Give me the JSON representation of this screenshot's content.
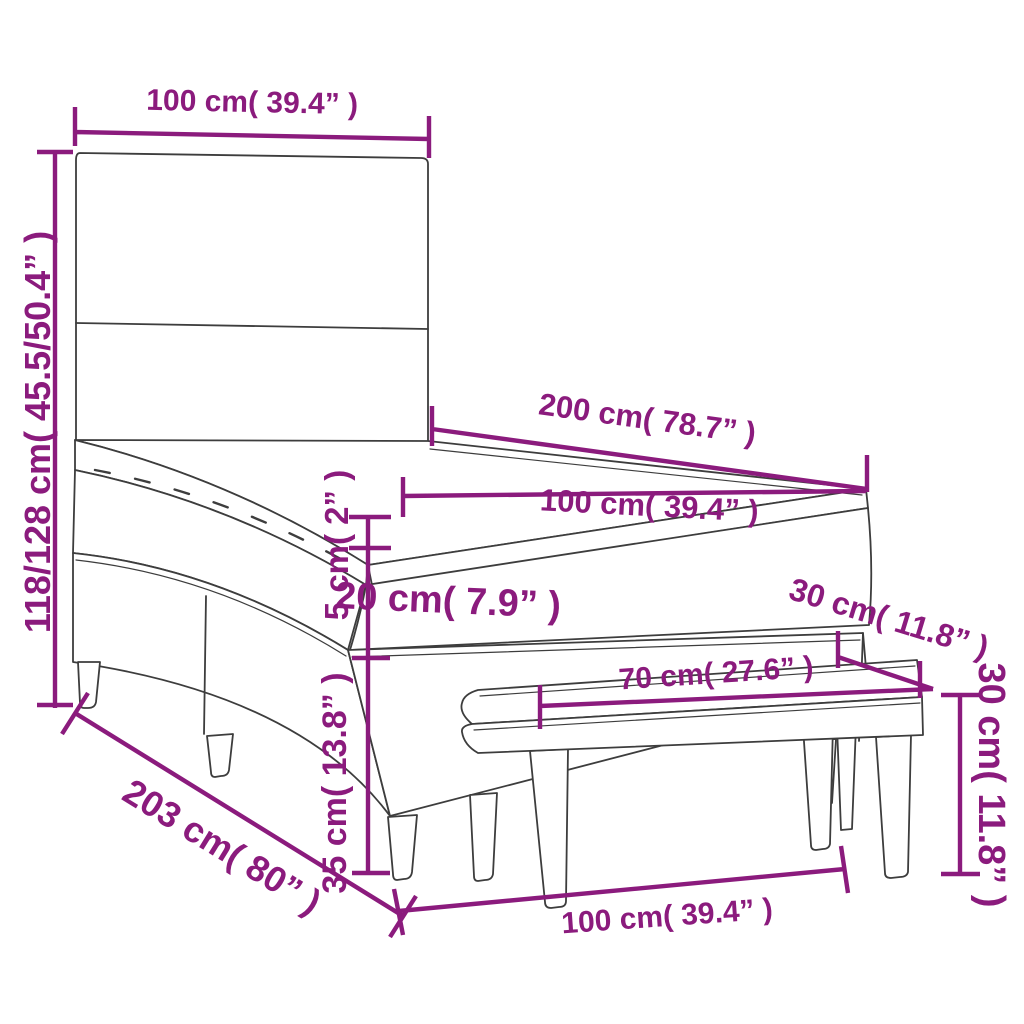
{
  "diagram": {
    "title": "Box spring bed with headboard, mattress topper and bench — dimension diagram",
    "colors": {
      "dimension_accent": "#8B1B7D",
      "line": "#3D3D3D",
      "background": "#FFFFFF"
    },
    "dimensions": {
      "headboard_width": {
        "label": "100 cm( 39.4” )"
      },
      "total_height": {
        "label": "118/128 cm( 45.5/50.4” )"
      },
      "mattress_length": {
        "label": "200 cm( 78.7” )"
      },
      "mattress_width": {
        "label": "100 cm( 39.4” )"
      },
      "topper_height": {
        "label": "5 cm( 2” )"
      },
      "mattress_height": {
        "label": "20 cm( 7.9” )"
      },
      "base_height": {
        "label": "35 cm( 13.8” )"
      },
      "bed_length": {
        "label": "203 cm( 80” )"
      },
      "bench_leg_span": {
        "label": "70 cm( 27.6” )"
      },
      "bench_depth": {
        "label": "30 cm( 11.8” )"
      },
      "bench_width": {
        "label": "100 cm( 39.4” )"
      },
      "bench_height": {
        "label": "30 cm( 11.8” )"
      }
    }
  }
}
